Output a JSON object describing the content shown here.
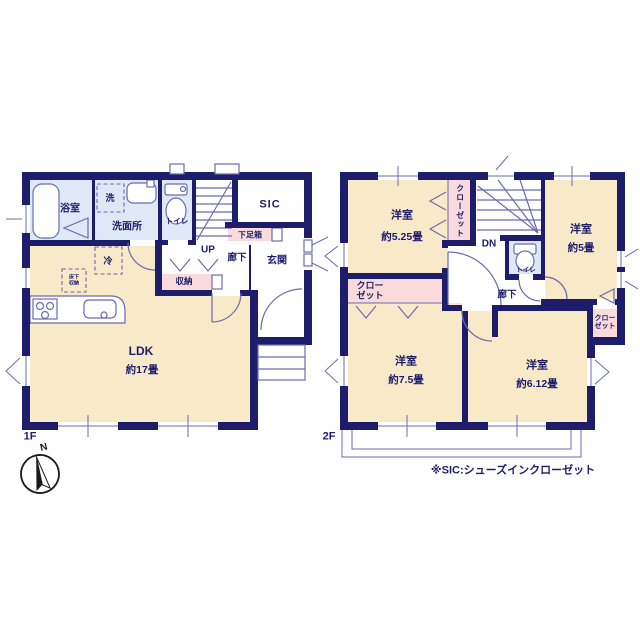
{
  "colors": {
    "wall": "#1d1d6b",
    "ink": "#1d1d6b",
    "room_cream": "#f8e9c9",
    "room_blue": "#dde9f6",
    "room_pink": "#f9dbdb",
    "line": "#6b6bad"
  },
  "floor1": {
    "label": "1F",
    "bath": "浴室",
    "washer": "洗",
    "washroom": "洗面所",
    "toilet": "トイレ",
    "stairs": "UP",
    "sic": "SIC",
    "shoebox": "下足箱",
    "hallway": "廊下",
    "entrance": "玄関",
    "storage": "収納",
    "fridge": "冷",
    "floor_storage_line1": "床下",
    "floor_storage_line2": "収納",
    "ldk": "LDK",
    "ldk_size": "約17畳"
  },
  "floor2": {
    "label": "2F",
    "bedroom1": "洋室",
    "bedroom1_size": "約5.25畳",
    "bedroom2": "洋室",
    "bedroom2_size": "約5畳",
    "bedroom3": "洋室",
    "bedroom3_size": "約7.5畳",
    "bedroom4": "洋室",
    "bedroom4_size": "約6.12畳",
    "closet": "クローゼット",
    "closet_line1": "クロー",
    "closet_line2": "ゼット",
    "stairs": "DN",
    "toilet": "トイレ",
    "hallway": "廊下"
  },
  "compass": {
    "north": "N"
  },
  "footnote": "※SIC:シューズインクローゼット"
}
